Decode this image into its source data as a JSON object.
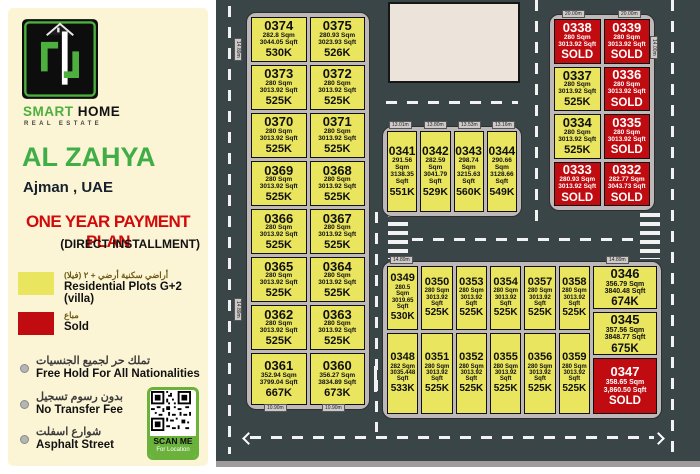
{
  "sidebar": {
    "brand_primary": "SMART",
    "brand_secondary": "HOME",
    "brand_subtitle": "REAL ESTATE",
    "project_title": "AL ZAHYA",
    "project_location": "Ajman , UAE",
    "offer_headline": "ONE YEAR PAYMENT PLAN",
    "offer_subheadline": "(DIRECT INSTALLMENT)",
    "legend": [
      {
        "key": "available",
        "color": "#e9e55e",
        "label_ar": "أراضي سكنية أرضي + ٢ (فيلا)",
        "label_en": "Residential Plots G+2 (villa)"
      },
      {
        "key": "sold",
        "color": "#c00c10",
        "label_ar": "مباع",
        "label_en": "Sold"
      }
    ],
    "features": [
      {
        "ar": "تملك حر لجميع الجنسيات",
        "en": "Free Hold For All Nationalities"
      },
      {
        "ar": "بدون رسوم تسجيل",
        "en": "No Transfer Fee"
      },
      {
        "ar": "شوارع اسفلت",
        "en": "Asphalt Street"
      }
    ],
    "qr_label": "SCAN ME",
    "qr_sublabel": "For Location"
  },
  "map": {
    "compass_label": "N",
    "colors": {
      "road": "#3a4547",
      "sidewalk": "#beb8b8",
      "available": "#e9e55e",
      "sold": "#c00c10"
    },
    "dim_tags": [
      {
        "text": "14.89m",
        "x": 242,
        "y": 38,
        "vertical": true
      },
      {
        "text": "14.89m",
        "x": 242,
        "y": 298,
        "vertical": true
      },
      {
        "text": "10.90m",
        "x": 264,
        "y": 404,
        "vertical": false
      },
      {
        "text": "10.90m",
        "x": 322,
        "y": 404,
        "vertical": false
      },
      {
        "text": "13.01m",
        "x": 389,
        "y": 121,
        "vertical": false
      },
      {
        "text": "13.80m",
        "x": 424,
        "y": 121,
        "vertical": false
      },
      {
        "text": "13.53m",
        "x": 458,
        "y": 121,
        "vertical": false
      },
      {
        "text": "13.16m",
        "x": 492,
        "y": 121,
        "vertical": false
      },
      {
        "text": "20.00m",
        "x": 562,
        "y": 10,
        "vertical": false
      },
      {
        "text": "20.00m",
        "x": 618,
        "y": 10,
        "vertical": false
      },
      {
        "text": "14.00m",
        "x": 658,
        "y": 36,
        "vertical": true
      },
      {
        "text": "14.89m",
        "x": 390,
        "y": 256,
        "vertical": false
      },
      {
        "text": "14.89m",
        "x": 606,
        "y": 256,
        "vertical": false
      }
    ],
    "blocks": {
      "west": {
        "plots": [
          {
            "id": "0374",
            "sqm": "282.8 Sqm",
            "sqft": "3044.05 Sqft",
            "price": "530K",
            "status": "available"
          },
          {
            "id": "0375",
            "sqm": "280.93 Sqm",
            "sqft": "3023.93 Sqft",
            "price": "526K",
            "status": "available"
          },
          {
            "id": "0373",
            "sqm": "280 Sqm",
            "sqft": "3013.92 Sqft",
            "price": "525K",
            "status": "available"
          },
          {
            "id": "0372",
            "sqm": "280 Sqm",
            "sqft": "3013.92 Sqft",
            "price": "525K",
            "status": "available"
          },
          {
            "id": "0370",
            "sqm": "280 Sqm",
            "sqft": "3013.92 Sqft",
            "price": "525K",
            "status": "available"
          },
          {
            "id": "0371",
            "sqm": "280 Sqm",
            "sqft": "3013.92 Sqft",
            "price": "525K",
            "status": "available"
          },
          {
            "id": "0369",
            "sqm": "280 Sqm",
            "sqft": "3013.92 Sqft",
            "price": "525K",
            "status": "available"
          },
          {
            "id": "0368",
            "sqm": "280 Sqm",
            "sqft": "3013.92 Sqft",
            "price": "525K",
            "status": "available"
          },
          {
            "id": "0366",
            "sqm": "280 Sqm",
            "sqft": "3013.92 Sqft",
            "price": "525K",
            "status": "available"
          },
          {
            "id": "0367",
            "sqm": "280 Sqm",
            "sqft": "3013.92 Sqft",
            "price": "525K",
            "status": "available"
          },
          {
            "id": "0365",
            "sqm": "280 Sqm",
            "sqft": "3013.92 Sqft",
            "price": "525K",
            "status": "available"
          },
          {
            "id": "0364",
            "sqm": "280 Sqm",
            "sqft": "3013.92 Sqft",
            "price": "525K",
            "status": "available"
          },
          {
            "id": "0362",
            "sqm": "280 Sqm",
            "sqft": "3013.92 Sqft",
            "price": "525K",
            "status": "available"
          },
          {
            "id": "0363",
            "sqm": "280 Sqm",
            "sqft": "3013.92 Sqft",
            "price": "525K",
            "status": "available"
          },
          {
            "id": "0361",
            "sqm": "352.94 Sqm",
            "sqft": "3799.04 Sqft",
            "price": "667K",
            "status": "available"
          },
          {
            "id": "0360",
            "sqm": "356.27 Sqm",
            "sqft": "3834.89 Sqft",
            "price": "673K",
            "status": "available"
          }
        ]
      },
      "center": {
        "plots": [
          {
            "id": "0341",
            "sqm": "291.56 Sqm",
            "sqft": "3138.35 Sqft",
            "price": "551K",
            "status": "available"
          },
          {
            "id": "0342",
            "sqm": "282.59 Sqm",
            "sqft": "3041.79 Sqft",
            "price": "529K",
            "status": "available"
          },
          {
            "id": "0343",
            "sqm": "298.74 Sqm",
            "sqft": "3215.63 Sqft",
            "price": "560K",
            "status": "available"
          },
          {
            "id": "0344",
            "sqm": "290.66 Sqm",
            "sqft": "3128.66 Sqft",
            "price": "549K",
            "status": "available"
          }
        ]
      },
      "northeast": {
        "plots": [
          {
            "id": "0338",
            "sqm": "280 Sqm",
            "sqft": "3013.92 Sqft",
            "price": "SOLD",
            "status": "sold"
          },
          {
            "id": "0339",
            "sqm": "280 Sqm",
            "sqft": "3013.92 Sqft",
            "price": "SOLD",
            "status": "sold"
          },
          {
            "id": "0337",
            "sqm": "280 Sqm",
            "sqft": "3013.92 Sqft",
            "price": "525K",
            "status": "available"
          },
          {
            "id": "0336",
            "sqm": "280 Sqm",
            "sqft": "3013.92 Sqft",
            "price": "SOLD",
            "status": "sold"
          },
          {
            "id": "0334",
            "sqm": "280 Sqm",
            "sqft": "3013.92 Sqft",
            "price": "525K",
            "status": "available"
          },
          {
            "id": "0335",
            "sqm": "280 Sqm",
            "sqft": "3013.92 Sqft",
            "price": "SOLD",
            "status": "sold"
          },
          {
            "id": "0333",
            "sqm": "280.93 Sqm",
            "sqft": "3013.92 Sqft",
            "price": "SOLD",
            "status": "sold"
          },
          {
            "id": "0332",
            "sqm": "282.77 Sqm",
            "sqft": "3043.73 Sqft",
            "price": "SOLD",
            "status": "sold"
          }
        ]
      },
      "south_main": {
        "plots": [
          {
            "id": "0349",
            "sqm": "280.5 Sqm",
            "sqft": "3019.65 Sqft",
            "price": "530K",
            "status": "available"
          },
          {
            "id": "0350",
            "sqm": "280 Sqm",
            "sqft": "3013.92 Sqft",
            "price": "525K",
            "status": "available"
          },
          {
            "id": "0353",
            "sqm": "280 Sqm",
            "sqft": "3013.92 Sqft",
            "price": "525K",
            "status": "available"
          },
          {
            "id": "0354",
            "sqm": "280 Sqm",
            "sqft": "3013.92 Sqft",
            "price": "525K",
            "status": "available"
          },
          {
            "id": "0357",
            "sqm": "280 Sqm",
            "sqft": "3013.92 Sqft",
            "price": "525K",
            "status": "available"
          },
          {
            "id": "0358",
            "sqm": "280 Sqm",
            "sqft": "3013.92 Sqft",
            "price": "525K",
            "status": "available"
          },
          {
            "id": "0348",
            "sqm": "282 Sqm",
            "sqft": "3035.448 Sqft",
            "price": "533K",
            "status": "available"
          },
          {
            "id": "0351",
            "sqm": "280 Sqm",
            "sqft": "3013.92 Sqft",
            "price": "525K",
            "status": "available"
          },
          {
            "id": "0352",
            "sqm": "280 Sqm",
            "sqft": "3013.92 Sqft",
            "price": "525K",
            "status": "available"
          },
          {
            "id": "0355",
            "sqm": "280 Sqm",
            "sqft": "3013.92 Sqft",
            "price": "525K",
            "status": "available"
          },
          {
            "id": "0356",
            "sqm": "280 Sqm",
            "sqft": "3013.92 Sqft",
            "price": "525K",
            "status": "available"
          },
          {
            "id": "0359",
            "sqm": "280 Sqm",
            "sqft": "3013.92 Sqft",
            "price": "525K",
            "status": "available"
          }
        ]
      },
      "south_side": {
        "plots": [
          {
            "id": "0346",
            "sqm": "356.79 Sqm",
            "sqft": "3840.48 Sqft",
            "price": "674K",
            "status": "available"
          },
          {
            "id": "0345",
            "sqm": "357.56 Sqm",
            "sqft": "3848.77 Sqft",
            "price": "675K",
            "status": "available"
          },
          {
            "id": "0347",
            "sqm": "358.65 Sqm",
            "sqft": "3,860.50 Sqft",
            "price": "SOLD",
            "status": "sold"
          }
        ]
      }
    }
  }
}
